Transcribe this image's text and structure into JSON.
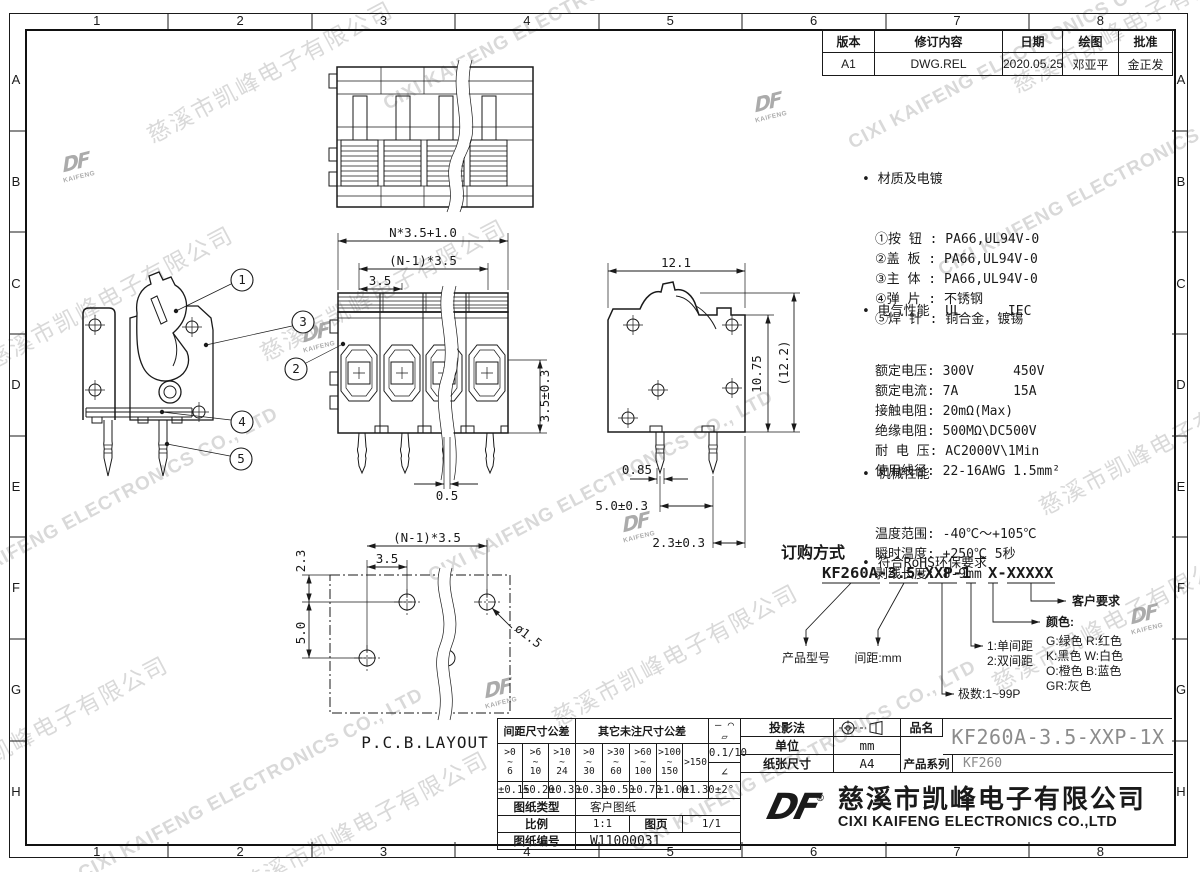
{
  "sheet": {
    "grid_cols": [
      "1",
      "2",
      "3",
      "4",
      "5",
      "6",
      "7",
      "8"
    ],
    "grid_rows": [
      "A",
      "B",
      "C",
      "D",
      "E",
      "F",
      "G",
      "H"
    ]
  },
  "revision": {
    "headers": [
      "版本",
      "修订内容",
      "日期",
      "绘图",
      "批准"
    ],
    "row": [
      "A1",
      "DWG.REL",
      "2020.05.25",
      "邓亚平",
      "金正发"
    ]
  },
  "notes": {
    "material_title": "• 材质及电镀",
    "material_lines": [
      "①按 钮 : PA66,UL94V-0",
      "②盖 板 : PA66,UL94V-0",
      "③主 体 : PA66,UL94V-0",
      "④弹 片 : 不锈钢",
      "⑤焊 针 : 铜合金，镀锡"
    ],
    "electrical_title": "• 电气性能  UL      IEC",
    "electrical_lines": [
      "额定电压: 300V     450V",
      "额定电流: 7A       15A",
      "接触电阻: 20mΩ(Max)",
      "绝缘电阻: 500MΩ\\DC500V",
      "耐 电 压: AC2000V\\1Min",
      "使用线径: 22-16AWG 1.5mm²"
    ],
    "mechanical_title": "• 机械性能",
    "mechanical_lines": [
      "温度范围: -40℃～+105℃",
      "瞬时温度: +250℃ 5秒",
      "剥线长度: 8-9mm"
    ],
    "rohs": "• 符合RoHS环保要求"
  },
  "ordering": {
    "title": "订购方式",
    "code_part1": "KF260A-3.5-XXP-1",
    "code_part2": "X-XXXXX",
    "product_model": "产品型号",
    "pitch": "间距:mm",
    "spacing_1": "1:单间距",
    "spacing_2": "2:双间距",
    "poles": "极数:1~99P",
    "color_title": "颜色:",
    "color_lines": [
      "G:绿色  R:红色",
      "K:黑色  W:白色",
      "O:橙色  B:蓝色",
      "GR:灰色"
    ],
    "customer": "客户要求"
  },
  "dims": {
    "front_total": "N*3.5+1.0",
    "front_span": "(N-1)*3.5",
    "front_pitch": "3.5",
    "front_height": "3.5±0.3",
    "front_pin": "0.5",
    "side_width": "12.1",
    "side_height": "10.75",
    "side_height_ref": "(12.2)",
    "side_pin_width": "0.85",
    "side_pin_pitch": "5.0±0.3",
    "side_pin_offset": "2.3±0.3",
    "pcb_offset": "2.3",
    "pcb_row_pitch": "5.0",
    "pcb_pitch": "3.5",
    "pcb_span": "(N-1)*3.5",
    "pcb_hole": "ø1.5",
    "pcb_title": "P.C.B.LAYOUT"
  },
  "callouts": [
    "1",
    "2",
    "3",
    "4",
    "5"
  ],
  "tolerance": {
    "pitch_header": "间距尺寸公差",
    "other_header": "其它未注尺寸公差",
    "ranges": [
      [
        ">0",
        "~",
        "6"
      ],
      [
        ">6",
        "~",
        "10"
      ],
      [
        ">10",
        "~",
        "24"
      ],
      [
        ">0",
        "~",
        "30"
      ],
      [
        ">30",
        "~",
        "60"
      ],
      [
        ">60",
        "~",
        "100"
      ],
      [
        ">100",
        "~",
        "150"
      ]
    ],
    "range_last": ">150",
    "values": [
      "±0.15",
      "±0.20",
      "±0.30",
      "±0.30",
      "±0.50",
      "±0.70",
      "±1.00",
      "±1.30"
    ],
    "symbols": "— ⌒ ▱",
    "flatness": "0.1/10",
    "angle_symbol": "∠",
    "angle_tol": "±2°",
    "doc_type_label": "图纸类型",
    "doc_type": "客户图纸",
    "scale_label": "比例",
    "scale": "1:1",
    "sheet_label": "图页",
    "sheet": "1/1",
    "number_label": "图纸编号",
    "number": "W11000031"
  },
  "titleblock": {
    "projection_label": "投影法",
    "unit_label": "单位",
    "unit": "mm",
    "paper_label": "纸张尺寸",
    "paper": "A4",
    "name_label": "品名",
    "part_number": "KF260A-3.5-XXP-1X",
    "series_label": "产品系列",
    "series": "KF260",
    "logo": "DF",
    "registered": "®",
    "company_cn": "慈溪市凯峰电子有限公司",
    "company_en": "CIXI KAIFENG ELECTRONICS CO.,LTD"
  },
  "watermark": {
    "cn": "慈溪市凯峰电子有限公司",
    "en": "CIXI KAIFENG ELECTRONICS CO., LTD",
    "logo_top": "DF",
    "logo_bottom": "KAIFENG"
  },
  "colors": {
    "line": "#1a1a1a",
    "part_number_gray": "#8c8c8c",
    "watermark_gray": "#c6c6c6"
  }
}
